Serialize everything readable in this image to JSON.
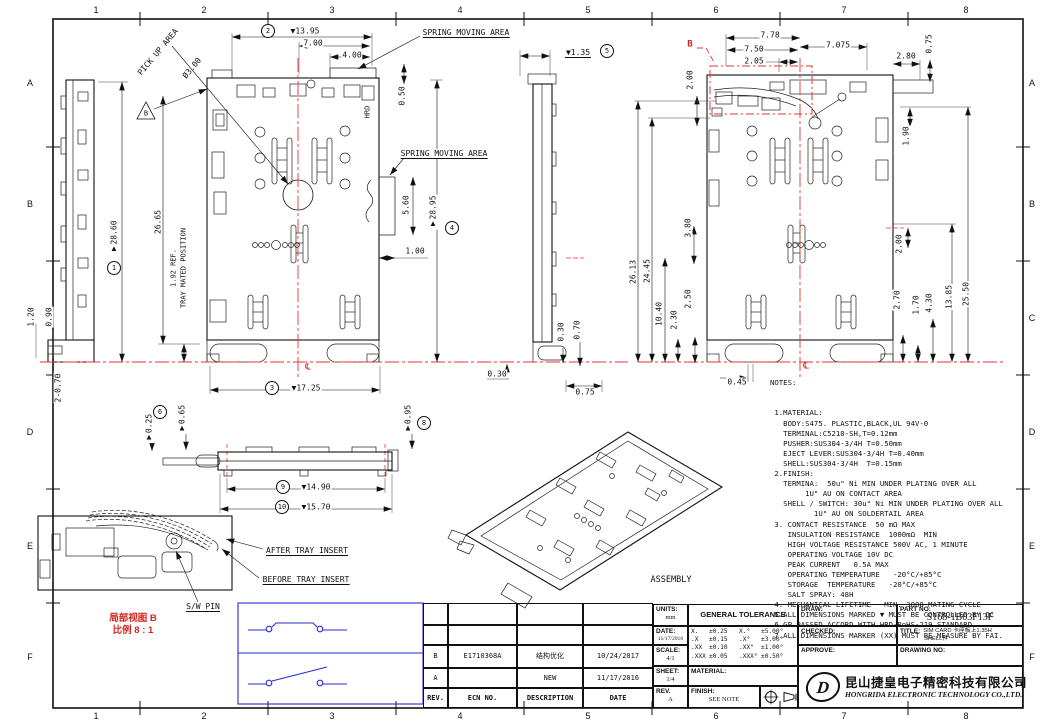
{
  "sheet": {
    "columns": [
      "1",
      "2",
      "3",
      "4",
      "5",
      "6",
      "7",
      "8"
    ],
    "rows": [
      "A",
      "B",
      "C",
      "D",
      "E",
      "F"
    ]
  },
  "colors": {
    "line": "#111111",
    "red": "#e8332e",
    "blue": "#2a2ad0"
  },
  "front_view": {
    "balloons": {
      "b1": "1",
      "b2": "2",
      "b3": "3",
      "b4": "4",
      "b5": "5"
    },
    "flag": "B",
    "pick_up_area": "PICK UP AREA",
    "pick_up_dia": "Ø3.00",
    "spring_area_top": "SPRING MOVING AREA",
    "spring_area_mid": "SPRING MOVING AREA",
    "hrd_mark": "HRD",
    "centerline_mark": "℄",
    "d13_95": "▼13.95",
    "d7_00": "7.00",
    "d4_00": "4.00",
    "d0_50": "0.50",
    "d1_35": "▼1.35",
    "d28_60": "▼28.60",
    "d26_65": "26.65",
    "d1_92": "1.92 REF.",
    "d1_92b": "TRAY MATED POSITION",
    "d1_20": "1.20",
    "d0_90": "0.90",
    "d2_070": "2-0.70",
    "d28_95": "▼28.95",
    "d5_60": "5.60",
    "d1_00": "1.00",
    "d17_25": "▼17.25",
    "d0_30c": "0.30",
    "d0_30s": "0.30",
    "d0_70s": "0.70",
    "d0_75s": "0.75"
  },
  "rear_view": {
    "ref_label": "B",
    "centerline_mark": "℄",
    "d7_78": "7.78",
    "d7_50": "7.50",
    "d2_05": "2.05",
    "d7_075": "7.075",
    "d2_80": "2.80",
    "d0_75": "0.75",
    "d2_00_top": "2.00",
    "d1_90": "1.90",
    "d26_13": "26.13",
    "d24_45": "24.45",
    "d3_80": "3.80",
    "d10_40": "10.40",
    "d2_30": "2.30",
    "d2_50": "2.50",
    "d0_45": "0.45",
    "d2_00_r": "2.00",
    "d2_70": "2.70",
    "d1_70": "1.70",
    "d4_30": "4.30",
    "d13_85": "13.85",
    "d25_50": "25.50"
  },
  "profile_view": {
    "balloons": {
      "b6": "6",
      "b8": "8",
      "b9": "9",
      "b10": "10"
    },
    "d0_25": "▼0.25",
    "d0_65": "▼0.65",
    "d0_95": "▼0.95",
    "d14_90": "▼14.90",
    "d15_70": "▼15.70"
  },
  "detail_b": {
    "after_insert": "AFTER TRAY INSERT",
    "before_insert": "BEFORE TRAY INSERT",
    "sw_pin": "S/W PIN",
    "caption_title": "局部视图 B",
    "caption_scale": "比例 8 : 1"
  },
  "assembly": {
    "label": "ASSEMBLY"
  },
  "notes": {
    "title": "NOTES:",
    "lines": [
      " 1.MATERIAL:",
      "   BODY:S475. PLASTIC,BLACK,UL 94V-0",
      "   TERMINAL:C5210-SH,T=0.12mm",
      "   PUSHER:SUS304-3/4H T=0.50mm",
      "   EJECT LEVER:SUS304-3/4H T=0.40mm",
      "   SHELL:SUS304-3/4H  T=0.15mm",
      " 2.FINISH:",
      "   TERMINA:  50u\" Ni MIN UNDER PLATING OVER ALL",
      "        1U\" AU ON CONTACT AREA",
      "   SHELL / SWITCH: 30u\" Ni MIN UNDER PLATING OVER ALL",
      "          1U\" AU ON SOLDERTAIL AREA",
      " 3. CONTACT RESISTANCE  50 mΩ MAX",
      "    INSULATION RESISTANCE  1000mΩ  MIN",
      "    HIGH VOLTAGE RESISTANCE 500V AC, 1 MINUTE",
      "    OPERATING VOLTAGE 10V DC",
      "    PEAK CURRENT   0.5A MAX",
      "    OPERATING TEMPERATURE   -20°C/+85°C",
      "    STORAGE  TEMPERATURE   -20°C/+85°C",
      "    SALT SPRAY: 48H",
      " 4. MECHANICAL LIFETIME   MIN. 3000 MATING CYCLE",
      " 5.ALL DIMENSIONS MARKED ▼ MUST BE CONTROLLED BY QC",
      " 6.GP PASSED ACCORD WITH HRD-RoHS-219 STANDARD.",
      " 7.ALL DIMENSIONS MARKER (XX) MUST BE MEASURE BY FAI."
    ]
  },
  "revisions": {
    "headers": [
      "REV.",
      "ECN NO.",
      "DESCRIPTION",
      "DATE"
    ],
    "rows": [
      [
        "",
        "",
        "",
        ""
      ],
      [
        "",
        "",
        "",
        ""
      ],
      [
        "B",
        "E1710368A",
        "结构优化",
        "10/24/2017"
      ],
      [
        "A",
        "",
        "NEW",
        "11/17/2016"
      ]
    ]
  },
  "title_block": {
    "units_label": "UNITS:",
    "units_value": "mm",
    "tolerance_header": "GENERAL TOLERANCE",
    "tolerance_rows": [
      [
        "X.",
        "±0.25",
        "X.°",
        "±5.00°"
      ],
      [
        ".X",
        "±0.15",
        ".X°",
        "±3.00°"
      ],
      [
        ".XX",
        "±0.10",
        ".XX°",
        "±1.00°"
      ],
      [
        ".XXX",
        "±0.05",
        ".XXX°",
        "±0.50°"
      ]
    ],
    "date_label": "DATE:",
    "date_value": "11/17/2016",
    "scale_label": "SCALE:",
    "scale_value": "4/1",
    "sheet_label": "SHEET:",
    "sheet_value": "1/4",
    "rev_label": "REV.",
    "rev_value": "A",
    "material_label": "MATERIAL:",
    "finish_label": "FINISH:",
    "finish_value": "SEE NOTE",
    "draw_label": "DRAW:",
    "checked_label": "CHECKED:",
    "approve_label": "APPROVE:",
    "part_no_label": "PART NO:",
    "part_no_value": "S168-1B03F13F",
    "title_label": "TITLE:",
    "title_line1": "SIM CARD 卡座板上1.35H",
    "title_line2": "SHELL件",
    "drawing_no_label": "DRAWING NO:",
    "company_cn": "昆山捷皇电子精密科技有限公司",
    "company_en": "HONGRIDA ELECTRONIC TECHNOLOGY CO.,LTD.",
    "logo_text": "D"
  }
}
